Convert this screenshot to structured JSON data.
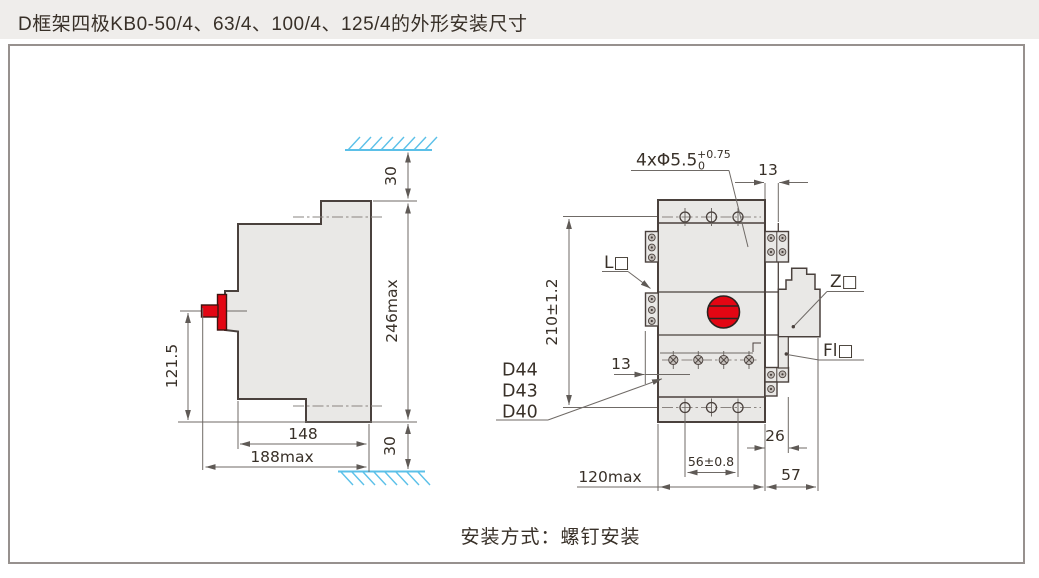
{
  "header": {
    "title": "D框架四极KB0-50/4、63/4、100/4、125/4的外形安装尺寸"
  },
  "caption": {
    "text": "安装方式：螺钉安装"
  },
  "colors": {
    "accent_red": "#e30613",
    "hatch_blue": "#5bc0e8",
    "line_dark": "#4a413d",
    "header_bg": "#efedeb",
    "part_fill": "#e9e8e6"
  },
  "side_view": {
    "dims": {
      "top_gap": "30",
      "height": "246max",
      "handle_height": "121.5",
      "depth_inner": "148",
      "depth_max": "188max",
      "bottom_gap": "30"
    }
  },
  "front_view": {
    "labels": {
      "hole_spec": "4xΦ5.5",
      "hole_tol_upper": "+0.75",
      "hole_tol_lower": "0",
      "terminal_left": "L□",
      "accessory_right": "Z□",
      "accessory_front": "Fl□",
      "model_d44": "D44",
      "model_d43": "D43",
      "model_d40": "D40"
    },
    "dims": {
      "rail_width_top": "13",
      "mount_pitch": "210±1.2",
      "terminal_depth": "13",
      "rail_offset": "26",
      "hole_span": "56±0.8",
      "width_max": "120max",
      "side_width": "57"
    }
  }
}
